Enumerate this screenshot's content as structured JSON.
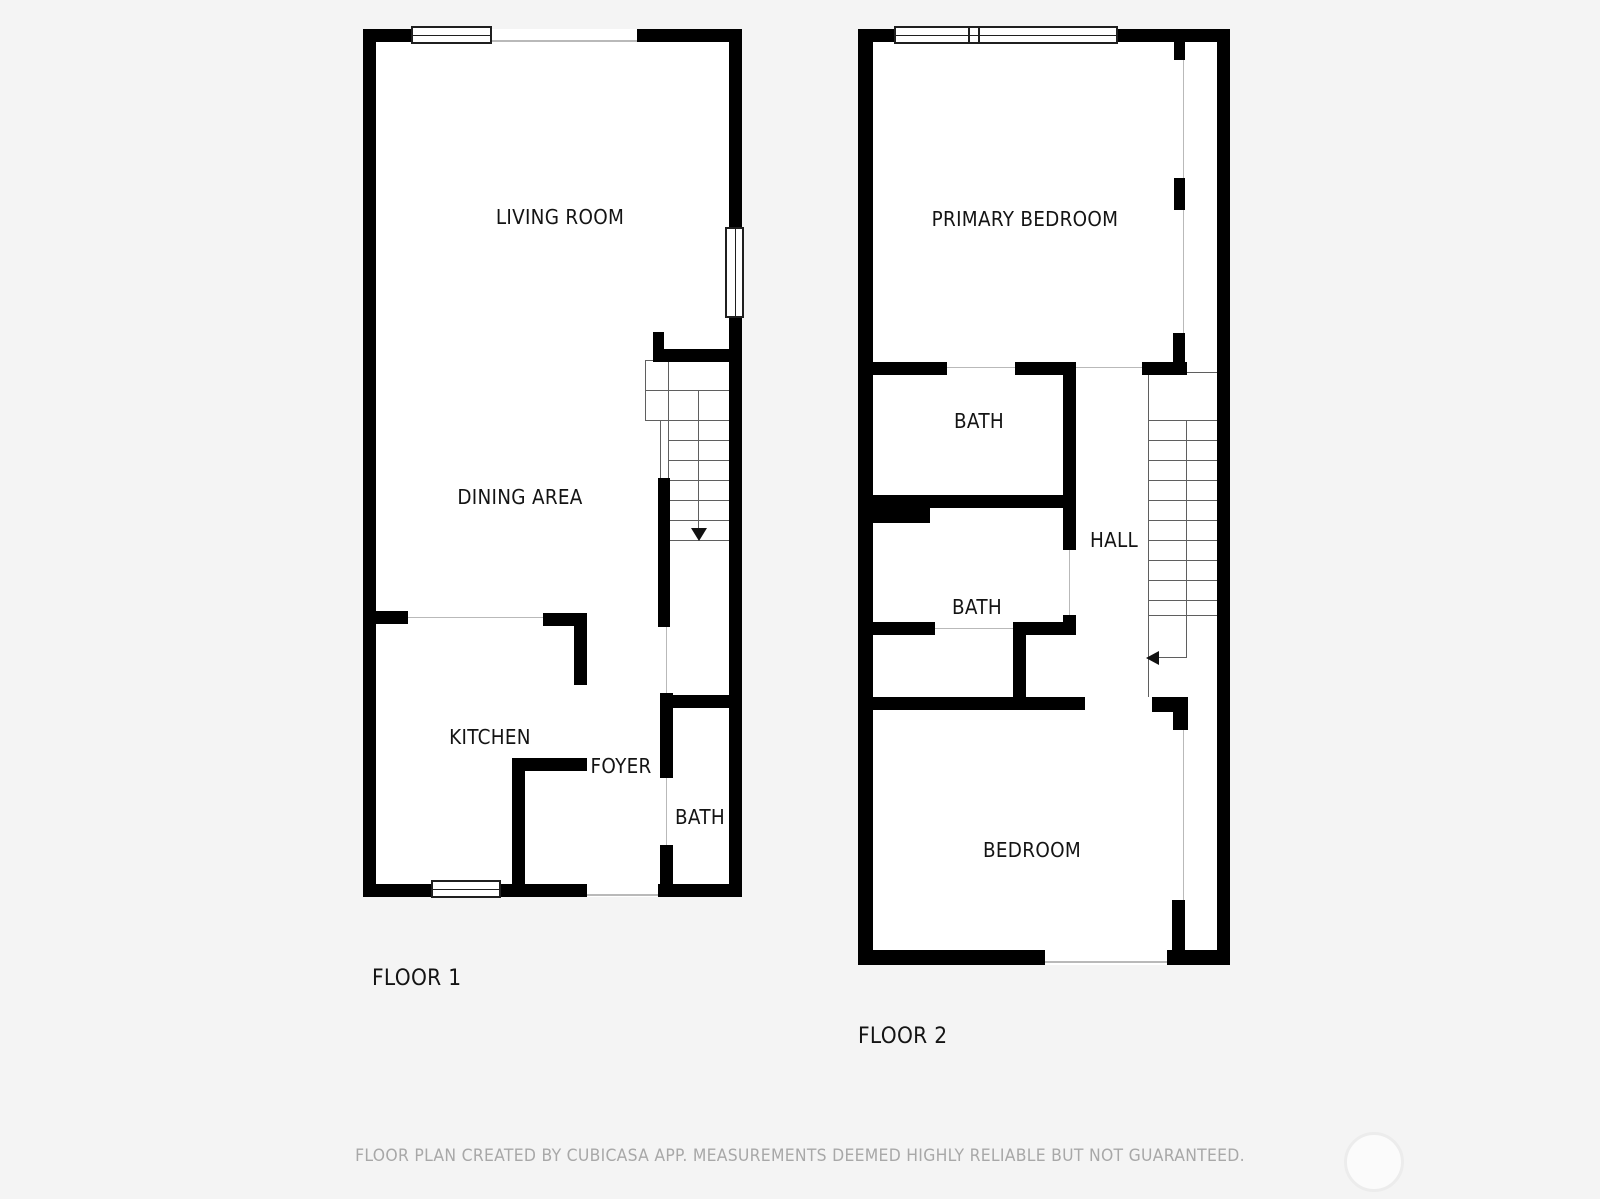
{
  "page": {
    "background_color": "#f4f4f4",
    "wall_color": "#000000",
    "room_fill_color": "#ffffff",
    "footer_disclaimer": "FLOOR PLAN CREATED BY CUBICASA APP. MEASUREMENTS DEEMED HIGHLY RELIABLE BUT NOT GUARANTEED."
  },
  "icons": {
    "stairs_down_arrow": "triangle-down",
    "stairs_left_arrow": "triangle-left",
    "watermark_circle": "circle-outline"
  },
  "floors": [
    {
      "label": "FLOOR 1",
      "stairs_direction": "down",
      "rooms": [
        {
          "name": "living-room",
          "label": "LIVING ROOM"
        },
        {
          "name": "dining-area",
          "label": "DINING AREA"
        },
        {
          "name": "kitchen",
          "label": "KITCHEN"
        },
        {
          "name": "foyer",
          "label": "FOYER"
        },
        {
          "name": "bath",
          "label": "BATH"
        }
      ]
    },
    {
      "label": "FLOOR 2",
      "stairs_direction": "left",
      "rooms": [
        {
          "name": "primary-bedroom",
          "label": "PRIMARY BEDROOM"
        },
        {
          "name": "bath-upper",
          "label": "BATH"
        },
        {
          "name": "hall",
          "label": "HALL"
        },
        {
          "name": "bath-lower",
          "label": "BATH"
        },
        {
          "name": "bedroom",
          "label": "BEDROOM"
        }
      ]
    }
  ]
}
